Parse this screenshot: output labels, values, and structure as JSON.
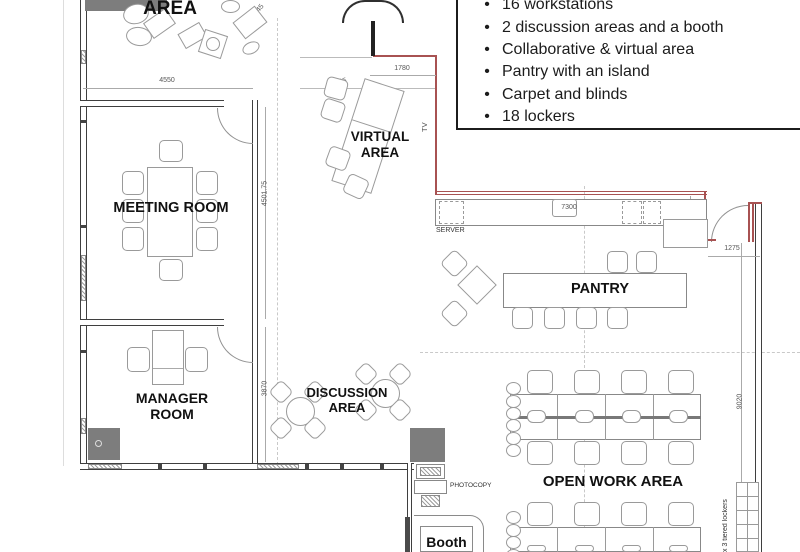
{
  "notes": {
    "bullet": "•",
    "items": [
      "16 workstations",
      "2 discussion areas and a booth",
      "Collaborative & virtual area",
      "Pantry with an island",
      "Carpet and blinds",
      "18 lockers"
    ]
  },
  "labels": {
    "area_partial": "AREA",
    "meeting_room": "MEETING ROOM",
    "manager_room": "MANAGER ROOM",
    "virtual_area": "VIRTUAL AREA",
    "discussion_area": "DISCUSSION AREA",
    "pantry": "PANTRY",
    "open_work_area": "OPEN WORK AREA",
    "booth": "Booth",
    "server": "SERVER",
    "tv": "TV",
    "photocopy": "PHOTOCOPY",
    "lockers_note": "x 3 tiered lockers"
  },
  "dimensions": {
    "top_width": "4550",
    "virtual_width": "1780",
    "virtual_depth": "4905",
    "collab_diag": "4045",
    "meeting_height": "4501.75",
    "manager_height": "3870",
    "counter_length": "7300",
    "counter_depth": "1145",
    "entry_width": "1275",
    "right_height": "9020"
  },
  "colors": {
    "boundary_red": "#a85252",
    "wall_gray": "#3f3f3f",
    "furniture_gray": "#9a9a9a",
    "cabinet_fill": "#7d7d7d"
  }
}
